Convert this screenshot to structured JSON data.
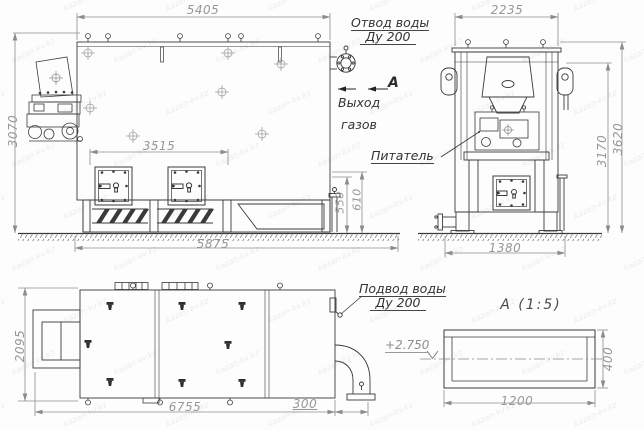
{
  "drawing": {
    "watermark": "kazan-kv.kz",
    "front_view": {
      "dim_width_top": "5405",
      "dim_height_left": "3070",
      "dim_hatch_span": "3515",
      "dim_base_inner": "550",
      "dim_base_outer": "610",
      "dim_ground_width": "5875"
    },
    "side_view": {
      "dim_width_top": "2235",
      "dim_height_inner": "3170",
      "dim_height_outer": "3620",
      "dim_base_width": "1380",
      "feeder_label": "Питатель"
    },
    "plan_view": {
      "dim_depth": "2095",
      "dim_length": "6755",
      "dim_pipe_extension": "300"
    },
    "annotations": {
      "water_outlet_line1": "Отвод воды",
      "water_outlet_line2": "Ду 200",
      "section_arrow_label": "А",
      "gas_exit_line1": "Выход",
      "gas_exit_line2": "газов",
      "water_inlet_line1": "Подвод воды",
      "water_inlet_line2": "Ду 200"
    },
    "detail_a": {
      "title": "А  (1:5)",
      "elevation_mark": "+2.750",
      "dim_width": "1200",
      "dim_height": "400"
    }
  }
}
